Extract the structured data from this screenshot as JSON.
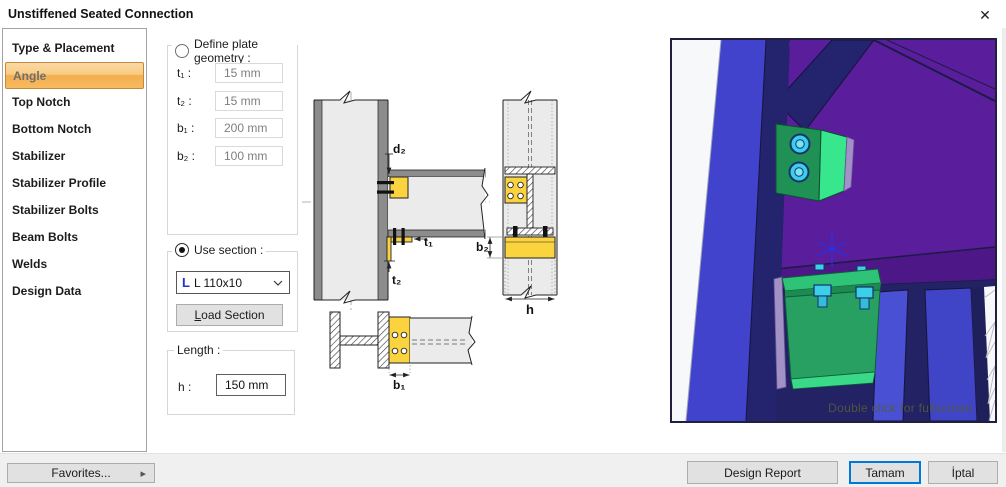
{
  "window": {
    "title": "Unstiffened Seated Connection",
    "close_glyph": "✕"
  },
  "sidebar": {
    "items": [
      {
        "label": "Type & Placement",
        "selected": false
      },
      {
        "label": "Angle",
        "selected": true
      },
      {
        "label": "Top Notch",
        "selected": false
      },
      {
        "label": "Bottom Notch",
        "selected": false
      },
      {
        "label": "Stabilizer",
        "selected": false
      },
      {
        "label": "Stabilizer Profile",
        "selected": false
      },
      {
        "label": "Stabilizer Bolts",
        "selected": false
      },
      {
        "label": "Beam Bolts",
        "selected": false
      },
      {
        "label": "Welds",
        "selected": false
      },
      {
        "label": "Design Data",
        "selected": false
      }
    ]
  },
  "plate": {
    "radio_label": "Define plate geometry :",
    "selected": false,
    "fields": [
      {
        "label": "t₁ :",
        "value": "15 mm"
      },
      {
        "label": "t₂ :",
        "value": "15 mm"
      },
      {
        "label": "b₁ :",
        "value": "200 mm"
      },
      {
        "label": "b₂ :",
        "value": "100 mm"
      }
    ]
  },
  "section": {
    "radio_label": "Use section :",
    "selected": true,
    "icon_glyph": "L",
    "value": "L 110x10",
    "load_mnemonic": "L",
    "load_rest": "oad Section"
  },
  "length": {
    "title": "Length :",
    "label": "h :",
    "value": "150 mm"
  },
  "diagram": {
    "labels": {
      "d2": "d₂",
      "t1": "t₁",
      "t2": "t₂",
      "b2": "b₂",
      "h": "h",
      "b1": "b₁"
    }
  },
  "viewport": {
    "hint": "Double click for fullscreen"
  },
  "footer": {
    "favorites": "Favorites...",
    "arrow_glyph": "▸",
    "design_report": "Design Report",
    "ok": "Tamam",
    "cancel": "İptal"
  },
  "colors": {
    "selection_orange": "#f5b04d",
    "selection_border": "#c48a3c",
    "steel_yellow": "#fbd33e",
    "steel_gray": "#ebebeb",
    "flange_gray": "#8c8c8c",
    "purple": "#5a1d9b",
    "navy": "#23236e",
    "blue": "#4143cd",
    "green": "#27a062",
    "green_bright": "#38e68e",
    "cyan_bolt": "#3ecfe8",
    "lavender": "#a291c7",
    "default_button_border": "#0078d7"
  }
}
